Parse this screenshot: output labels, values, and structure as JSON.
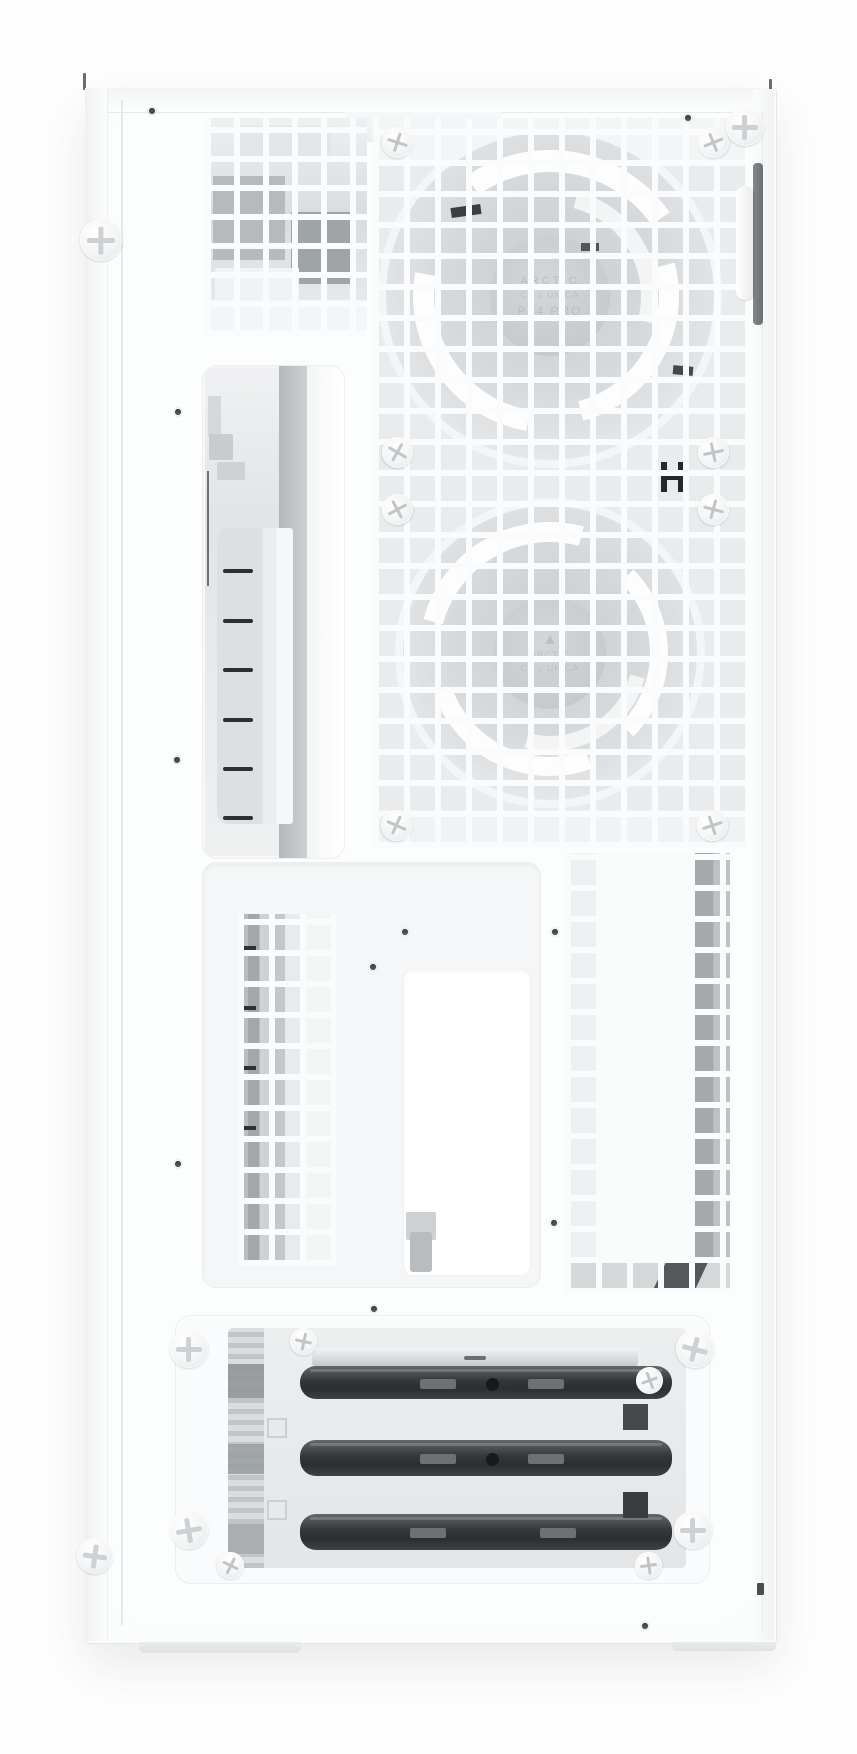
{
  "subject": "White mid-tower PC case shown from the meshed side/rear panel, two pre-installed fans visible behind the vent grid, ladder bracket and three-bay HDD cage",
  "markings": {
    "fan_top": {
      "brand": "ARCTIC",
      "certs": "C€ ▵ UK CA",
      "model": "P14 PRO"
    },
    "fan_bottom": {
      "logo": "▲",
      "brand": "ARCTIC",
      "certs": "C€ ▵ UK CA"
    }
  },
  "colors": {
    "page_bg": "#fefefe",
    "case_white": "#fcfdfd",
    "rail_shade": "#f3f4f5",
    "mesh_bar": "#fafbfc",
    "fan_gray": "#d6d9db",
    "interior_gray": "#c6c9cb",
    "slot_dark": "#33363a",
    "screw_face": "#f3f4f5",
    "edge_line": "#e4e6e7",
    "hole_dot": "#4c4f52"
  }
}
